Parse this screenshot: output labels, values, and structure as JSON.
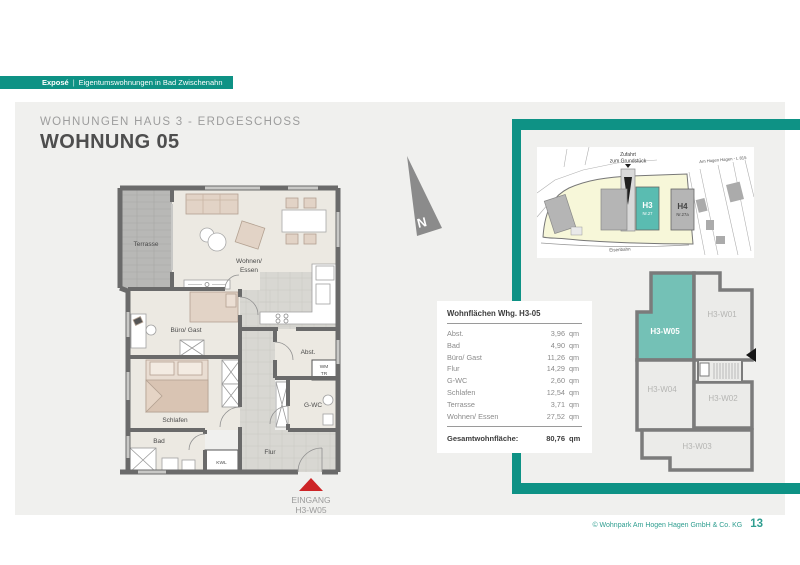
{
  "header": {
    "badge": {
      "label": "Exposé",
      "sep": "|",
      "text": "Eigentumswohnungen in Bad Zwischenahn"
    },
    "subtitle": "WOHNUNGEN HAUS 3 - ERDGESCHOSS",
    "title": "WOHNUNG 05"
  },
  "colors": {
    "accent_teal": "#0e9285",
    "siteplan_building_teal": "#5abcb1",
    "keyplan_unit_teal": "#74c1b6",
    "entrance_red": "#cd2426"
  },
  "floorplan": {
    "labels": {
      "terrasse": "Terrasse",
      "wohnen_line1": "Wohnen/",
      "wohnen_line2": "Essen",
      "buero": "Büro/ Gast",
      "abst": "Abst.",
      "wm": "WM",
      "tr": "TR",
      "gwc": "G-WC",
      "schlafen": "Schlafen",
      "bad": "Bad",
      "flur": "Flur",
      "kwl": "KWL",
      "eingang_line1": "EINGANG",
      "eingang_line2": "H3-W05",
      "north": "N"
    }
  },
  "siteplan": {
    "labels": {
      "zufahrt_line1": "Zufahrt",
      "zufahrt_line2": "zum Grundstück",
      "street": "Am Hogen Hagen - L 815",
      "h3": "H3",
      "h3_nr": "Nr.27",
      "h4": "H4",
      "h4_nr": "Nr.27a",
      "eisenbahn": "Eisenbahn"
    }
  },
  "keyplan": {
    "units": {
      "w05": "H3-W05",
      "w01": "H3-W01",
      "w04": "H3-W04",
      "w02": "H3-W02",
      "w03": "H3-W03"
    }
  },
  "table": {
    "title": "Wohnflächen Whg. H3-05",
    "rows": [
      {
        "label": "Abst.",
        "value": "3,96",
        "unit": "qm"
      },
      {
        "label": "Bad",
        "value": "4,90",
        "unit": "qm"
      },
      {
        "label": "Büro/ Gast",
        "value": "11,26",
        "unit": "qm"
      },
      {
        "label": "Flur",
        "value": "14,29",
        "unit": "qm"
      },
      {
        "label": "G-WC",
        "value": "2,60",
        "unit": "qm"
      },
      {
        "label": "Schlafen",
        "value": "12,54",
        "unit": "qm"
      },
      {
        "label": "Terrasse",
        "value": "3,71",
        "unit": "qm"
      },
      {
        "label": "Wohnen/ Essen",
        "value": "27,52",
        "unit": "qm"
      }
    ],
    "total": {
      "label": "Gesamtwohnfläche:",
      "value": "80,76",
      "unit": "qm"
    }
  },
  "footer": {
    "copyright": "© Wohnpark Am Hogen Hagen GmbH & Co. KG",
    "page": "13"
  }
}
